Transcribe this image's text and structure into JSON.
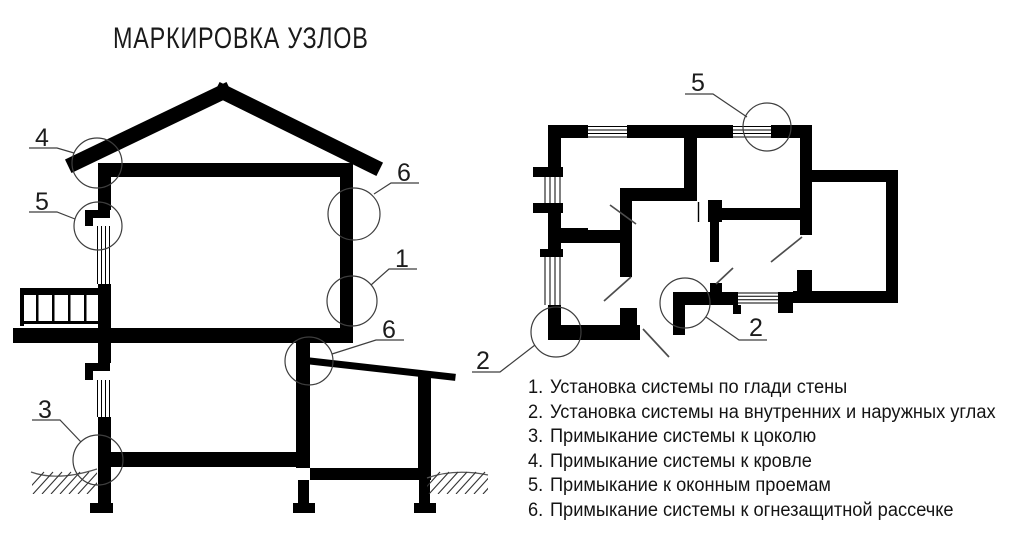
{
  "title": "МАРКИРОВКА УЗЛОВ",
  "section_markers": [
    {
      "label": "4"
    },
    {
      "label": "5"
    },
    {
      "label": "3"
    },
    {
      "label": "6"
    },
    {
      "label": "1"
    },
    {
      "label": "6"
    }
  ],
  "plan_markers": [
    {
      "label": "5"
    },
    {
      "label": "2"
    },
    {
      "label": "2"
    }
  ],
  "legend": [
    {
      "num": "1.",
      "text": "Установка системы по глади стены"
    },
    {
      "num": "2.",
      "text": "Установка системы на внутренних и наружных углах"
    },
    {
      "num": "3.",
      "text": "Примыкание системы к цоколю"
    },
    {
      "num": "4.",
      "text": "Примыкание системы к кровле"
    },
    {
      "num": "5.",
      "text": "Примыкание к оконным проемам"
    },
    {
      "num": "6.",
      "text": "Примыкание системы к огнезащитной рассечке"
    }
  ],
  "colors": {
    "ink": "#000000",
    "thin_line": "#3e3e3e",
    "background": "#ffffff"
  }
}
